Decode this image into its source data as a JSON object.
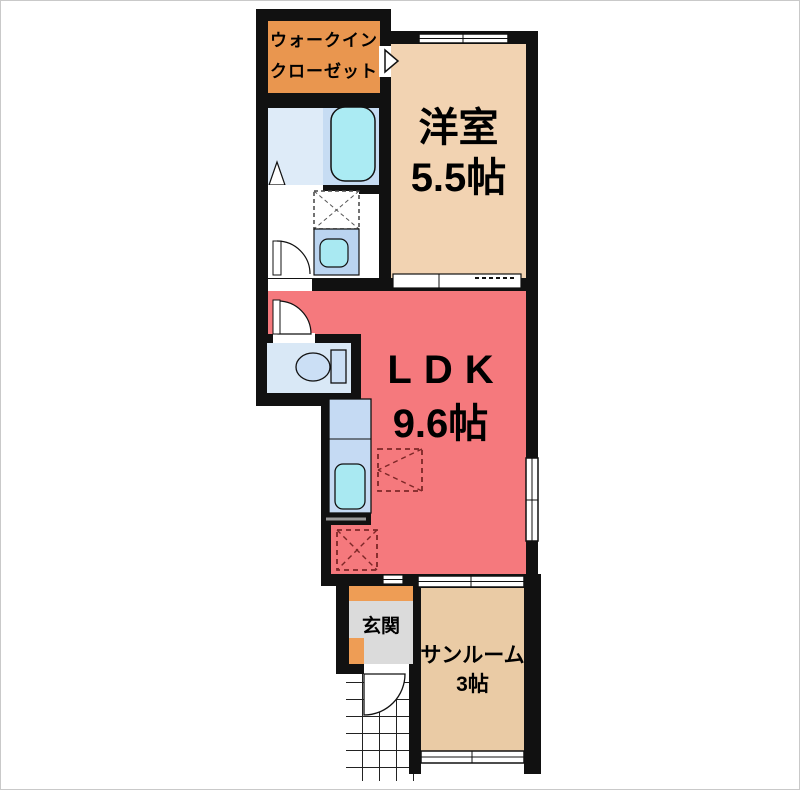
{
  "page": {
    "type": "floor-plan",
    "style": "japanese-madori"
  },
  "labels": {
    "walk_in_closet": {
      "line1": "ウォークイン",
      "line2": "クローゼット"
    },
    "western_room": {
      "name": "洋室",
      "size": "5.5帖"
    },
    "ldk": {
      "name": "LDK",
      "size": "9.6帖"
    },
    "entrance": {
      "name": "玄関"
    },
    "sunroom": {
      "name": "サンルーム",
      "size": "3帖"
    }
  },
  "colors": {
    "wall": "#111111",
    "walk_in_closet": "#E9964F",
    "western_room": "#F2D3B2",
    "ldk": "#F5797D",
    "sunroom": "#EACBA5",
    "entrance_floor": "#DBDBDB",
    "entrance_accent": "#EE9D55",
    "bath_floor": "#DEEBF8",
    "bath_tub_area": "#C6DCF3",
    "bathtub": "#ABEBF3",
    "toilet_floor": "#D9E8F6",
    "toilet_fixture": "#CBDFF5",
    "kitchen_counter": "#C5DAF3",
    "sink": "#A9E9F2",
    "washbasin_unit": "#BAD4F0",
    "placement_marker_dash": "#7D2727"
  },
  "fixtures": [
    "bathtub",
    "folding-bath-door",
    "washing-machine-pan",
    "washbasin",
    "toilet",
    "kitchen-counter",
    "kitchen-sink",
    "refrigerator-space-marker",
    "storage-space-marker",
    "entrance-door",
    "sliding-door",
    "window",
    "tiled-approach"
  ]
}
